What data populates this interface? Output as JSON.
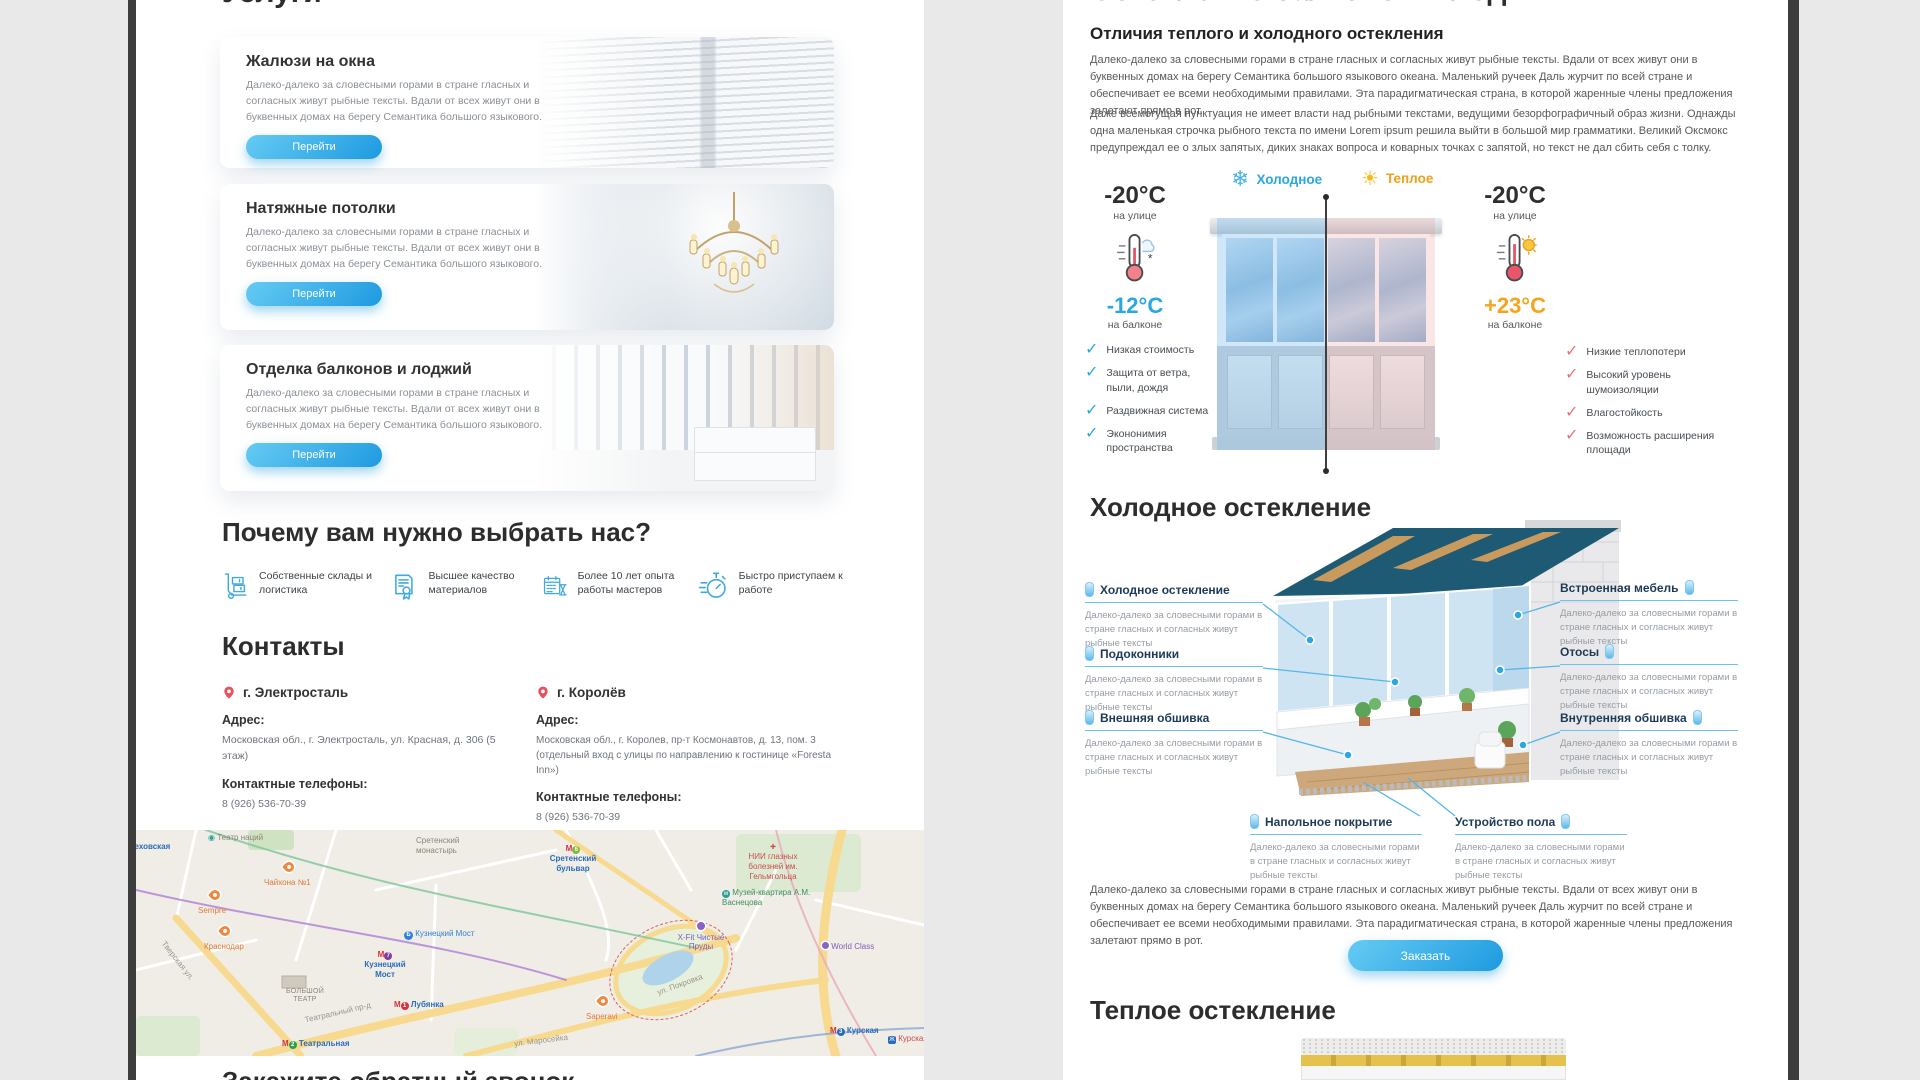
{
  "background": "#e9e9e9",
  "accent": "#2aa7e2",
  "left_page": {
    "services_title": "Услуги",
    "service_cards": [
      {
        "title": "Жалюзи на окна",
        "desc": "Далеко-далеко за словесными горами в стране гласных и согласных живут рыбные тексты. Вдали от всех живут они в буквенных домах на берегу Семантика большого языкового.",
        "button": "Перейти"
      },
      {
        "title": "Натяжные потолки",
        "desc": "Далеко-далеко за словесными горами в стране гласных и согласных живут рыбные тексты. Вдали от всех живут они в буквенных домах на берегу Семантика большого языкового.",
        "button": "Перейти"
      },
      {
        "title": "Отделка балконов и лоджий",
        "desc": "Далеко-далеко за словесными горами в стране гласных и согласных живут рыбные тексты. Вдали от всех живут они в буквенных домах на берегу Семантика большого языкового.",
        "button": "Перейти"
      }
    ],
    "why_title": "Почему вам нужно выбрать нас?",
    "features": [
      "Собственные склады и логистика",
      "Высшее качество материалов",
      "Более 10 лет опыта работы мастеров",
      "Быстро приступаем к работе"
    ],
    "contacts_title": "Контакты",
    "contacts": [
      {
        "city": "г. Электросталь",
        "address_label": "Адрес:",
        "address": "Московская обл., г. Электросталь, ул. Красная, д. 306 (5 этаж)",
        "phones_label": "Контактные телефоны:",
        "phone": "8 (926) 536-70-39"
      },
      {
        "city": "г. Королёв",
        "address_label": "Адрес:",
        "address": "Московская обл., г. Королев, пр-т Космонавтов, д. 13, пом. 3 (отдельный вход с улицы по направлению к гостинице «Foresta Inn»)",
        "phones_label": "Контактные телефоны:",
        "phone": "8 (926) 536-70-39"
      }
    ],
    "map_labels": {
      "chehovskaya": "Чеховская",
      "teatr_naciy": "Театр наций",
      "sretensky_monastery": "Сретенский монастырь",
      "chaihona": "Чайхона №1",
      "sempre": "Sempre",
      "krasnodar": "Краснодар",
      "kuznetsky_most_poi": "Кузнецкий Мост",
      "kuznetsky_most_metro": "Кузнецкий Мост",
      "bolshoi_teatr": "БОЛЬШОЙ ТЕАТР",
      "teatralny_proezd": "Театральный пр-д",
      "lubyanka": "Лубянка",
      "teatralnaya": "Театральная",
      "tverskaya": "Тверская ул.",
      "maroseyka": "ул. Маросейка",
      "sretensky_bulvar": "Сретенский бульвар",
      "nii": "НИИ глазных болезней им. Гельмгольца",
      "museum": "Музей-квартира А.М. Васнецова",
      "xfit": "X-Fit Чистые Пруды",
      "world_class": "World Class",
      "saperavi": "Saperavi",
      "kurskaya": "Курская",
      "kurskaya_rail": "Курская",
      "pokrovka": "ул. Покровка"
    },
    "callback_title": "Закажите обратный звонок"
  },
  "right_page": {
    "title": "Остекление балконов и лоджий",
    "subtitle": "Отличия теплого и холодного остекления",
    "paragraph1": "Далеко-далеко за словесными горами в стране гласных и согласных живут рыбные тексты. Вдали от всех живут они в буквенных домах на берегу Семантика большого языкового океана. Маленький ручеек Даль журчит по всей стране и обеспечивает ее всеми необходимыми правилами. Эта парадигматическая страна, в которой жаренные члены предложения залетают прямо в рот.",
    "paragraph2": "Даже всемогущая пунктуация не имеет власти над рыбными текстами, ведущими безорфографичный образ жизни. Однажды одна маленькая строчка рыбного текста по имени Lorem ipsum решила выйти в большой мир грамматики. Великий Оксмокс предупреждал ее о злых запятых, диких знаках вопроса и коварных точках с запятой, но текст не дал сбить себя с толку.",
    "comparison": {
      "cold_label": "Холодное",
      "warm_label": "Теплое",
      "cold_outside_temp": "-20°C",
      "cold_outside_caption": "на улице",
      "cold_balcony_temp": "-12°C",
      "cold_balcony_caption": "на балконе",
      "warm_outside_temp": "-20°C",
      "warm_outside_caption": "на улице",
      "warm_balcony_temp": "+23°C",
      "warm_balcony_caption": "на балконе",
      "cold_benefits": [
        "Низкая стоимость",
        "Защита от ветра, пыли, дождя",
        "Раздвижная система",
        "Экононимия пространства"
      ],
      "warm_benefits": [
        "Низкие теплопотери",
        "Высокий уровень шумоизоляции",
        "Влагостойкость",
        "Возможность расширения площади"
      ]
    },
    "cold_section_title": "Холодное остекление",
    "callout_desc": "Далеко-далеко за словесными горами в стране гласных и согласных живут рыбные тексты",
    "callouts_left": [
      "Холодное остекление",
      "Подоконники",
      "Внешняя обшивка"
    ],
    "callouts_right": [
      "Встроенная мебель",
      "Отосы",
      "Внутренняя обшивка"
    ],
    "callouts_bottom": [
      "Напольное покрытие",
      "Устройство пола"
    ],
    "bottom_paragraph": "Далеко-далеко за словесными горами в стране гласных и согласных живут рыбные тексты. Вдали от всех живут они в буквенных домах на берегу Семантика большого языкового океана. Маленький ручеек Даль журчит по всей стране и обеспечивает ее всеми необходимыми правилами. Эта парадигматическая страна, в которой жаренные члены предложения залетают прямо в рот.",
    "order_button": "Заказать",
    "warm_section_title": "Теплое остекление"
  }
}
